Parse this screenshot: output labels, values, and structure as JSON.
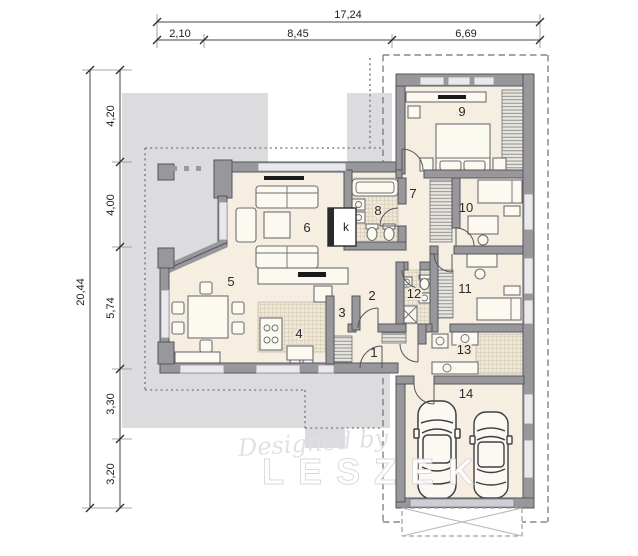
{
  "title": "house-floor-plan",
  "dimensions": {
    "top": {
      "total": "17,24",
      "segments": [
        "2,10",
        "8,45",
        "6,69"
      ]
    },
    "left": {
      "total": "20,44",
      "segments": [
        "4,20",
        "4,00",
        "5,74",
        "3,30",
        "3,20"
      ]
    }
  },
  "rooms": [
    {
      "label": "1"
    },
    {
      "label": "2"
    },
    {
      "label": "3"
    },
    {
      "label": "4"
    },
    {
      "label": "5"
    },
    {
      "label": "6"
    },
    {
      "label": "7"
    },
    {
      "label": "8"
    },
    {
      "label": "9"
    },
    {
      "label": "10"
    },
    {
      "label": "11"
    },
    {
      "label": "12"
    },
    {
      "label": "13"
    },
    {
      "label": "14"
    }
  ],
  "fireplace_label": "k",
  "watermark": {
    "script": "Designed by",
    "name": "LESZEK"
  },
  "colors": {
    "floor": "#f5eee1",
    "terrace": "#dcdcdf",
    "wall": "#97979c",
    "roof_line": "#85858b"
  }
}
